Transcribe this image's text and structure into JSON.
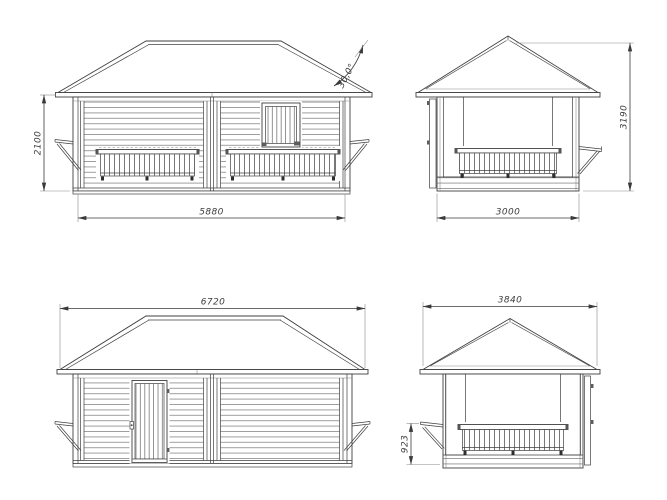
{
  "drawing": {
    "background": "#ffffff",
    "line_color": "#3f3f3f",
    "dim_color": "#3d3d3d",
    "views": {
      "front": {
        "dim_width": "5880",
        "dim_height": "2100",
        "roof_angle": "30,0°"
      },
      "side_right": {
        "dim_width": "3000",
        "dim_height": "3190"
      },
      "rear": {
        "dim_width": "6720"
      },
      "side_left": {
        "dim_width": "3840",
        "dim_counter_height": "923"
      }
    }
  }
}
